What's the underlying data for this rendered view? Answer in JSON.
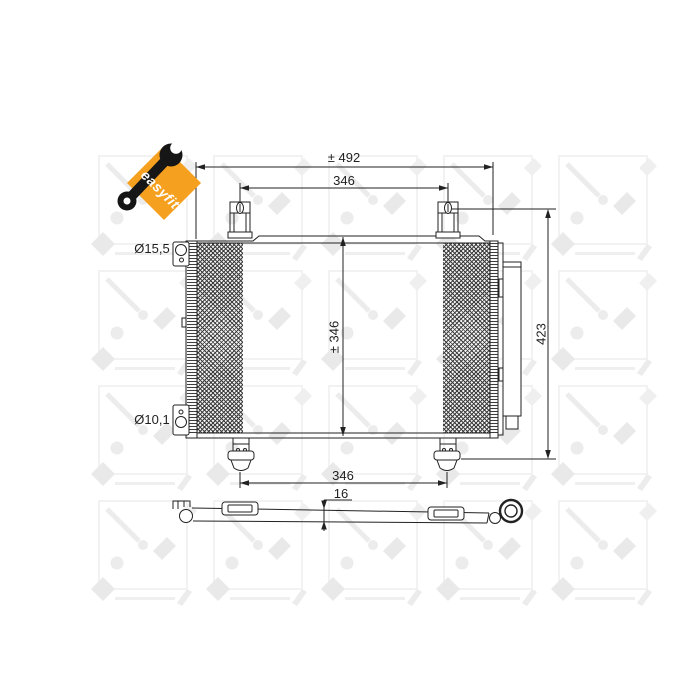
{
  "colors": {
    "accent_orange": "#F6A01F",
    "wrench_black": "#161616",
    "line": "#222222",
    "watermark_gray": "#ececec",
    "background": "#ffffff"
  },
  "logo": {
    "label": "easyfit"
  },
  "watermark": {
    "brand": "NRF"
  },
  "drawing": {
    "dimensions": {
      "total_width": "± 492",
      "top_bracket_span": "346",
      "core_height": "± 346",
      "overall_height": "423",
      "bottom_foot_span": "346",
      "profile_thickness": "16"
    },
    "ports": {
      "top_fitting_diameter": "Ø15,5",
      "bottom_fitting_diameter": "Ø10,1"
    }
  }
}
